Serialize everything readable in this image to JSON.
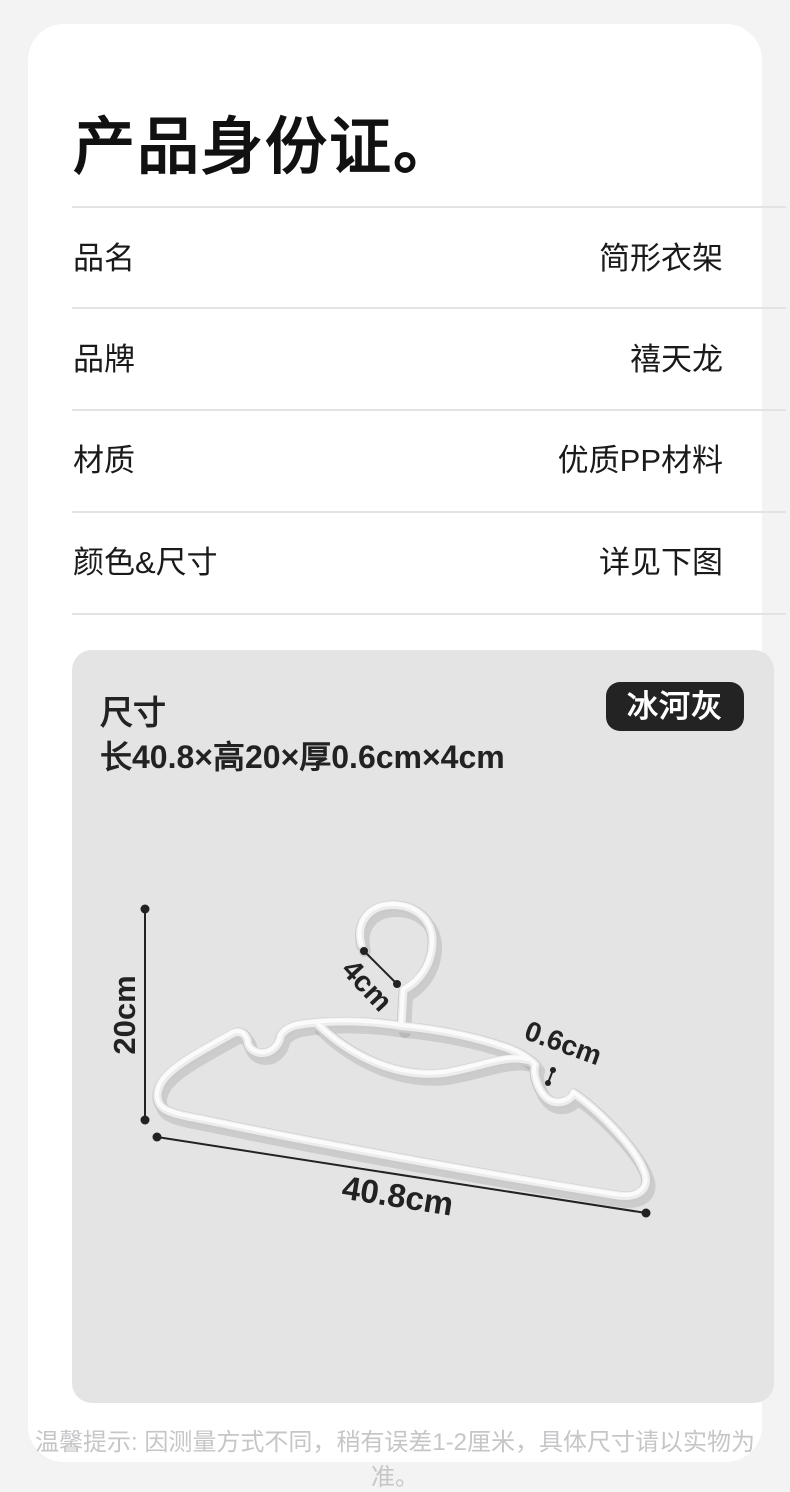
{
  "card": {
    "title": "产品身份证。",
    "rows": [
      {
        "label": "品名",
        "value": "简形衣架"
      },
      {
        "label": "品牌",
        "value": "禧天龙"
      },
      {
        "label": "材质",
        "value": "优质PP材料"
      },
      {
        "label": "颜色&尺寸",
        "value": "详见下图"
      }
    ],
    "footer_note": "温馨提示: 因测量方式不同，稍有误差1-2厘米，具体尺寸请以实物为准。"
  },
  "panel": {
    "size_label": "尺寸",
    "size_value": "长40.8×高20×厚0.6cm×4cm",
    "color_badge": "冰河灰"
  },
  "diagram": {
    "height_label": "20cm",
    "hook_label": "4cm",
    "thickness_label": "0.6cm",
    "width_label": "40.8cm"
  },
  "colors": {
    "page_background": "#f3f3f4",
    "card_background": "#ffffff",
    "panel_background": "#e4e4e5",
    "badge_background": "#232323",
    "text_dark": "#1a1a1a",
    "footer_text": "#c6c6c8",
    "dimension_line": "#222222",
    "hanger_tube": "#ededee"
  }
}
